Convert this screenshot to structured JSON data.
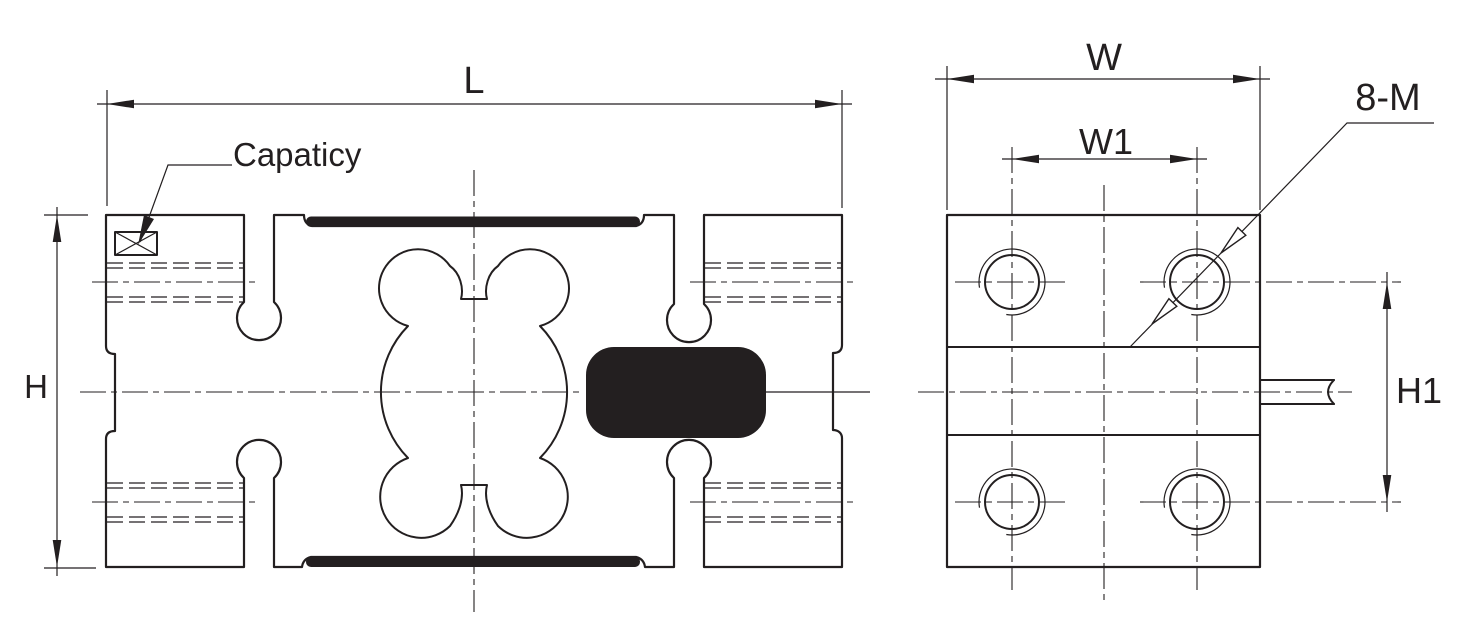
{
  "colors": {
    "ink": "#231f20",
    "background": "#ffffff"
  },
  "side_view": {
    "dim_length": "L",
    "dim_height": "H",
    "capacity_label": "Capaticy"
  },
  "end_view": {
    "dim_width": "W",
    "dim_hole_span_width": "W1",
    "dim_hole_span_height": "H1",
    "thread_callout": "8-M"
  }
}
